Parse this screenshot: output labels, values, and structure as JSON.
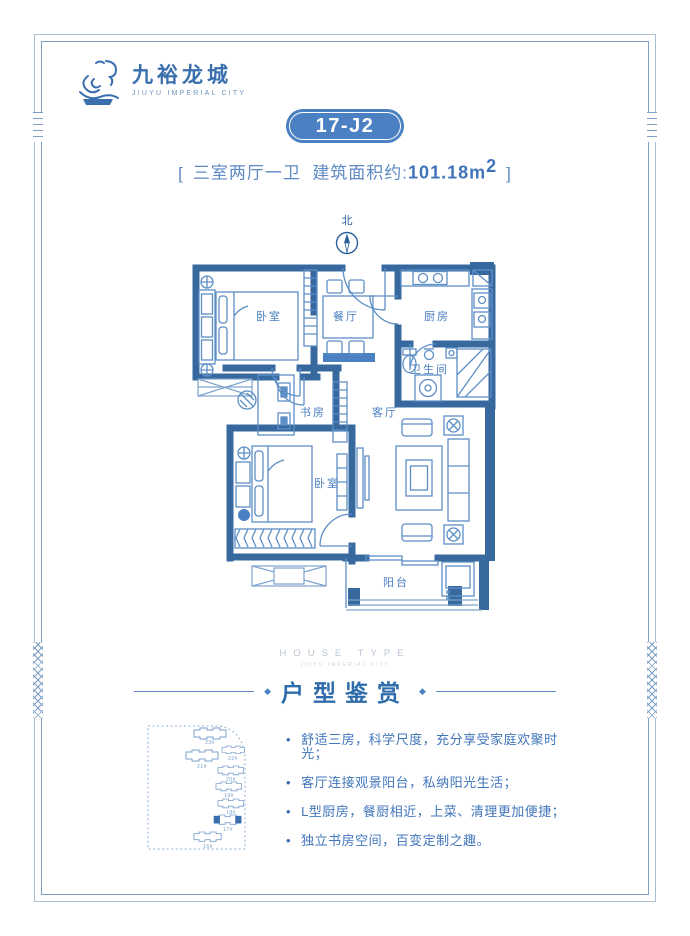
{
  "brand": {
    "name": "九裕龙城",
    "name_en": "JIUYU IMPERIAL CITY"
  },
  "header": {
    "unit_code": "17-J2",
    "bracket_left": "[",
    "rooms_text": "三室两厅一卫",
    "area_label": "建筑面积约:",
    "area_value": "101.18m",
    "area_sup": "2",
    "bracket_right": "]"
  },
  "compass": {
    "label": "北"
  },
  "floor_plan": {
    "rooms": [
      {
        "id": "bedroom-1",
        "label": "卧室"
      },
      {
        "id": "dining-room",
        "label": "餐厅"
      },
      {
        "id": "kitchen",
        "label": "厨房"
      },
      {
        "id": "bathroom",
        "label": "卫生间"
      },
      {
        "id": "study",
        "label": "书房"
      },
      {
        "id": "living-room",
        "label": "客厅"
      },
      {
        "id": "bedroom-2",
        "label": "卧室"
      },
      {
        "id": "balcony",
        "label": "阳台"
      }
    ]
  },
  "section": {
    "eyebrow": "HOUSE TYPE",
    "eyebrow_sub": "JIUYU IMPERIAL CITY",
    "title": "户型鉴赏",
    "ornament": "◆"
  },
  "features": {
    "bullet": "•",
    "items": [
      "舒适三房，科学尺度，充分享受家庭欢聚时光；",
      "客厅连接观景阳台，私纳阳光生活；",
      "L型厨房，餐厨相近，上菜、清理更加便捷；",
      "独立书房空间，百变定制之趣。"
    ]
  },
  "site_map": {
    "buildings": [
      {
        "label": "23#",
        "highlight": false
      },
      {
        "label": "21#",
        "highlight": false
      },
      {
        "label": "22#",
        "highlight": false
      },
      {
        "label": "20#",
        "highlight": false
      },
      {
        "label": "19#",
        "highlight": false
      },
      {
        "label": "18#",
        "highlight": false
      },
      {
        "label": "17#",
        "highlight": true
      },
      {
        "label": "16#",
        "highlight": false
      }
    ]
  },
  "colors": {
    "accent": "#4b80c2",
    "wall": "#37699f",
    "furniture_line": "#5c8fc6",
    "text_blue": "#4176bb",
    "frame_line": "#7da0c6",
    "title_blue": "#2f6cab",
    "eyebrow_gray": "#b9c5d1"
  }
}
